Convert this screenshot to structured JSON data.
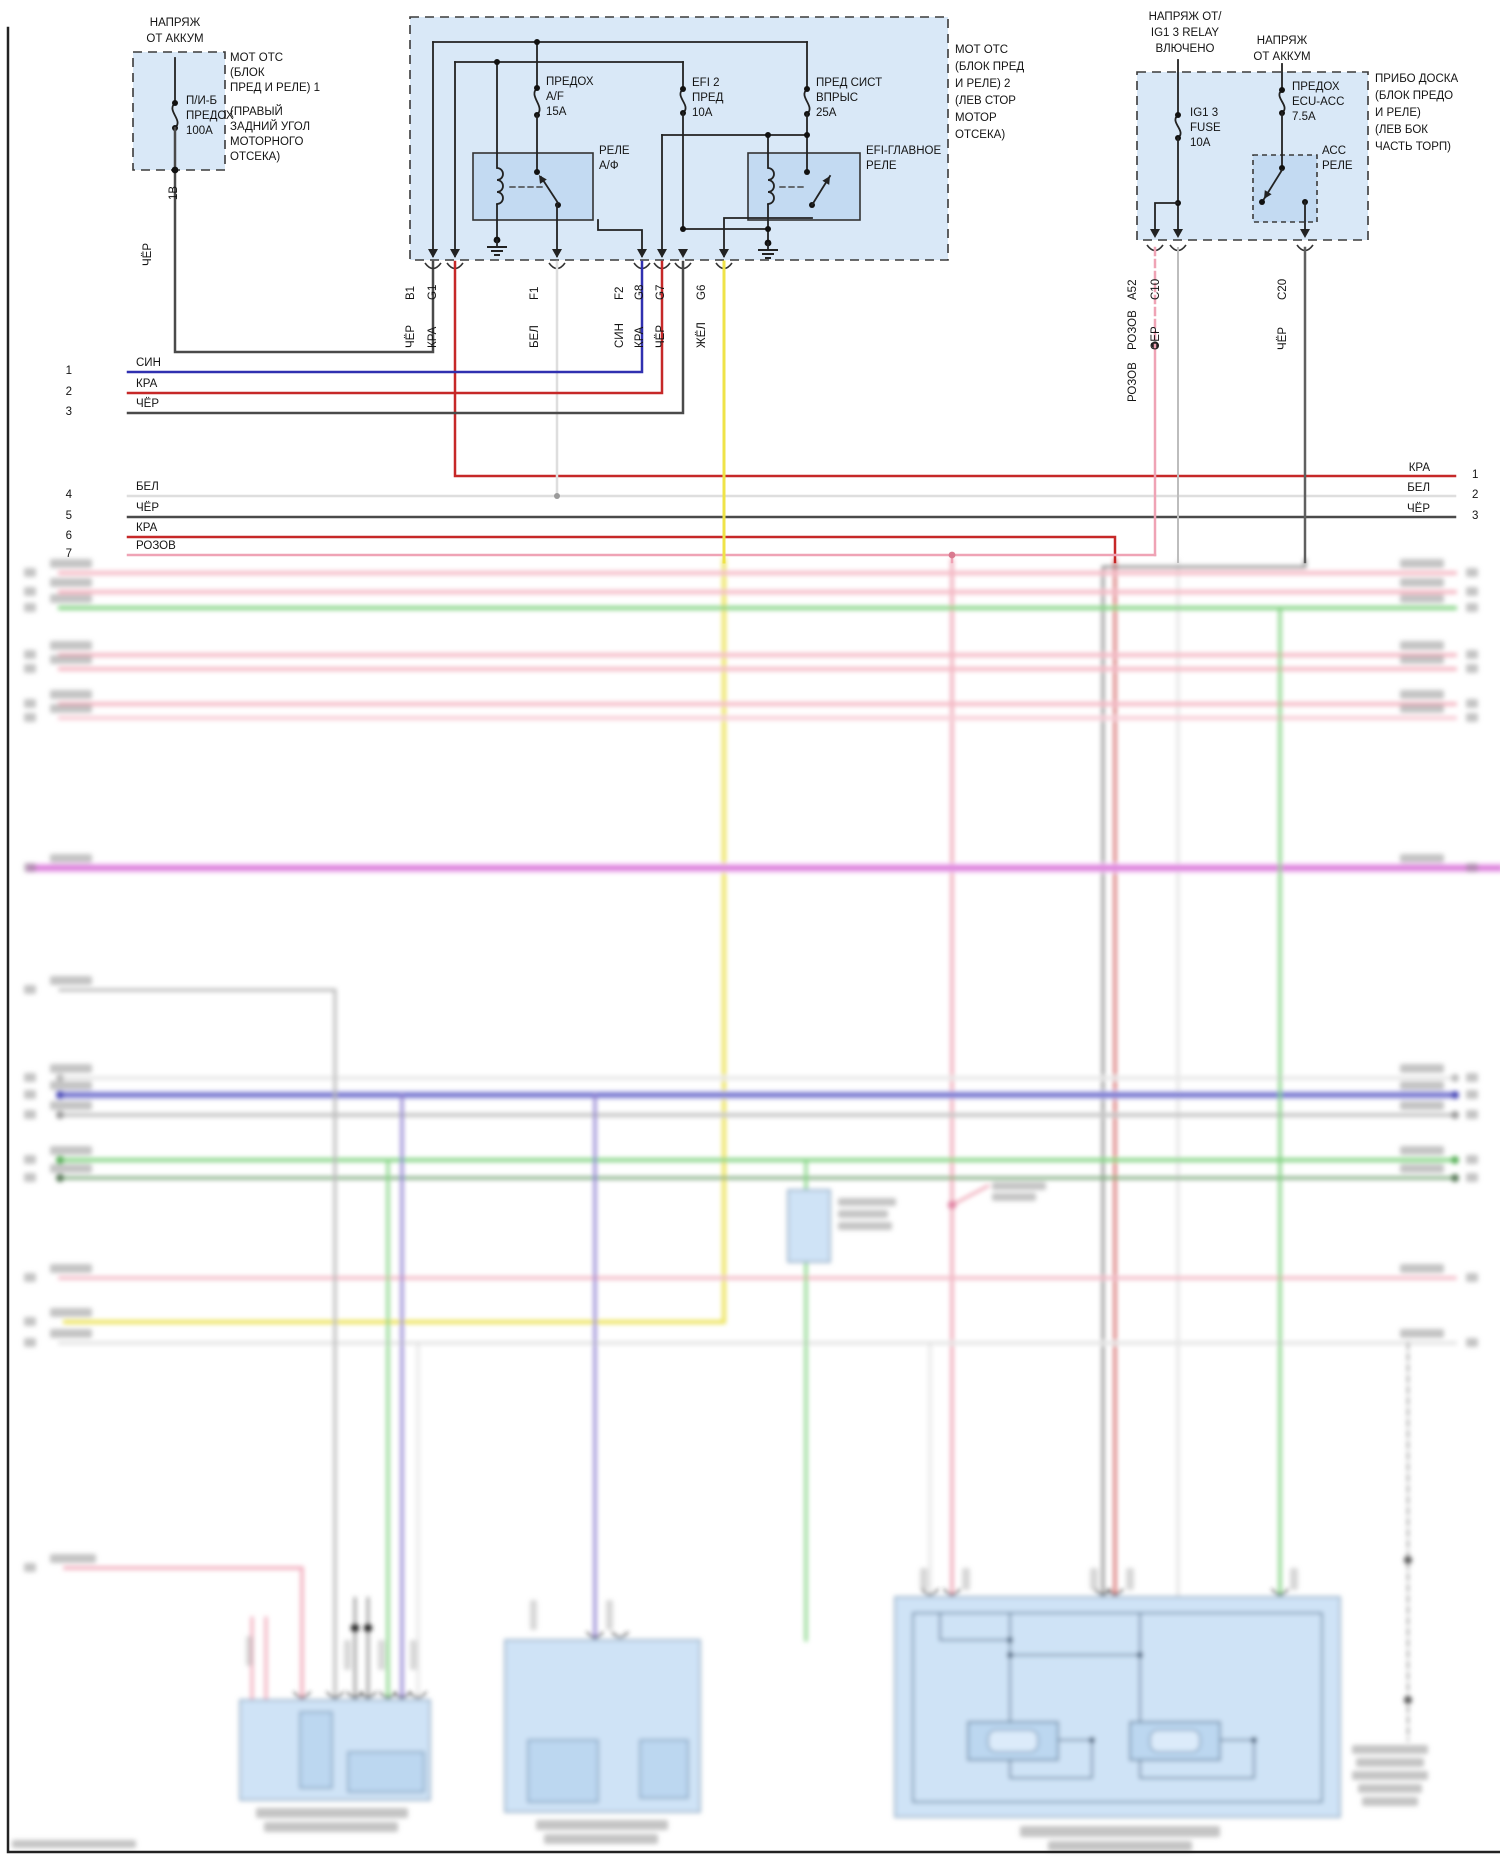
{
  "palette": {
    "box_fill": "#d9e8f7",
    "box_inner_fill": "#c3daf2",
    "wire_black": "#4a4a4a",
    "wire_red": "#c62828",
    "wire_blue": "#3030b0",
    "wire_white": "#dedede",
    "wire_yellow": "#efe348",
    "wire_pink": "#efa3b5",
    "wire_gray": "#bdbdbd",
    "wire_green": "#84d484",
    "wire_magenta": "#d66ad6",
    "wire_purple": "#8f7fd0"
  },
  "fuse_box_engine_1": {
    "feed_line1": "НАПРЯЖ",
    "feed_line2": "ОТ АККУМ",
    "fuse_line1": "П/И-Б",
    "fuse_line2": "ПРЕДОХ",
    "fuse_line3": "100А",
    "name_line1": "МОТ ОТС",
    "name_line2": "(БЛОК",
    "name_line3": "ПРЕД И РЕЛЕ) 1",
    "loc_line1": "(ПРАВЫЙ",
    "loc_line2": "ЗАДНИЙ УГОЛ",
    "loc_line3": "МОТОРНОГО",
    "loc_line4": "ОТСЕКА)",
    "wire_id": "1В",
    "wire_color": "ЧЁР"
  },
  "fuse_box_engine_2": {
    "name_line1": "МОТ ОТС",
    "name_line2": "(БЛОК ПРЕД",
    "name_line3": "И РЕЛЕ) 2",
    "name_line4": "(ЛЕВ СТОР",
    "name_line5": "МОТОР",
    "name_line6": "ОТСЕКА)",
    "fuse_af_line1": "ПРЕДОХ",
    "fuse_af_line2": "A/F",
    "fuse_af_line3": "15А",
    "fuse_efi2_line1": "EFI 2",
    "fuse_efi2_line2": "ПРЕД",
    "fuse_efi2_line3": "10А",
    "fuse_inj_line1": "ПРЕД СИСТ",
    "fuse_inj_line2": "ВПРЫС",
    "fuse_inj_line3": "25А",
    "relay_af_line1": "РЕЛЕ",
    "relay_af_line2": "А/Ф",
    "relay_efi_line1": "EFI-ГЛАВНОЕ",
    "relay_efi_line2": "РЕЛЕ",
    "pins": [
      {
        "id": "B1",
        "color": "ЧЁР"
      },
      {
        "id": "G1",
        "color": "КРА"
      },
      {
        "id": "F1",
        "color": "БЕЛ"
      },
      {
        "id": "F2",
        "color": "СИН"
      },
      {
        "id": "G8",
        "color": "КРА"
      },
      {
        "id": "G7",
        "color": "ЧЁР"
      },
      {
        "id": "G6",
        "color": "ЖЁЛ"
      }
    ]
  },
  "dash_panel_box": {
    "feed_ig_line1": "НАПРЯЖ ОТ/",
    "feed_ig_line2": "IG1 3 RELAY",
    "feed_ig_line3": "ВЛЮЧЕНО",
    "feed_bat_line1": "НАПРЯЖ",
    "feed_bat_line2": "ОТ АККУМ",
    "fuse_ig_line1": "IG1 3",
    "fuse_ig_line2": "FUSE",
    "fuse_ig_line3": "10А",
    "fuse_ecu_line1": "ПРЕДОХ",
    "fuse_ecu_line2": "ECU-ACC",
    "fuse_ecu_line3": "7.5А",
    "relay_acc_line1": "АСС",
    "relay_acc_line2": "РЕЛЕ",
    "name_line1": "ПРИБО ДОСКА",
    "name_line2": "(БЛОК ПРЕДО",
    "name_line3": "И РЕЛЕ)",
    "name_line4": "(ЛЕВ БОК",
    "name_line5": "ЧАСТЬ ТОРП)",
    "pins": [
      {
        "id": "A52",
        "color": "РОЗОВ"
      },
      {
        "id": "C10",
        "color": "СЕР"
      },
      {
        "id": "C20",
        "color": "ЧЁР"
      }
    ],
    "splice_label": "РОЗОВ"
  },
  "left_rows": [
    {
      "num": "1",
      "color": "СИН"
    },
    {
      "num": "2",
      "color": "КРА"
    },
    {
      "num": "3",
      "color": "ЧЁР"
    },
    {
      "num": "4",
      "color": "БЕЛ"
    },
    {
      "num": "5",
      "color": "ЧЁР"
    },
    {
      "num": "6",
      "color": "КРА"
    },
    {
      "num": "7",
      "color": "РОЗОВ"
    }
  ],
  "right_rows": [
    {
      "color": "КРА",
      "num": "1"
    },
    {
      "color": "БЕЛ",
      "num": "2"
    },
    {
      "color": "ЧЁР",
      "num": "3"
    }
  ]
}
